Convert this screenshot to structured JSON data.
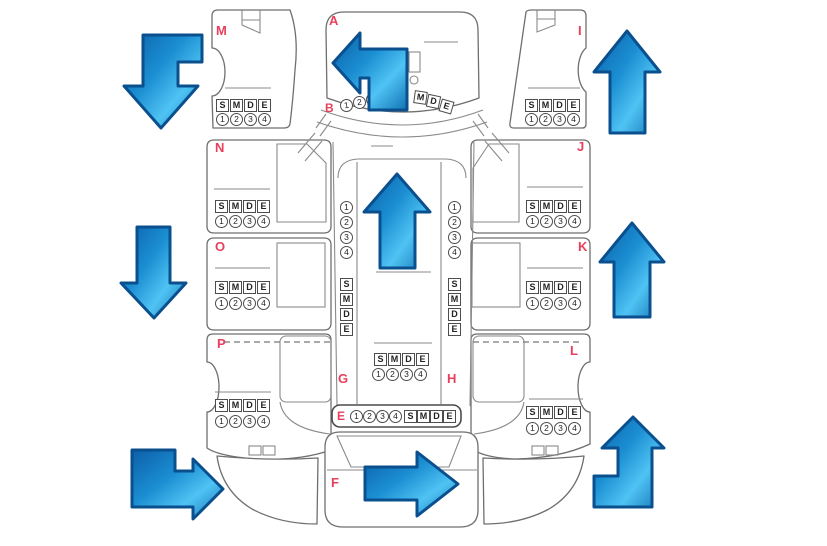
{
  "diagram": {
    "panels": {
      "A": "A",
      "B": "B",
      "E": "E",
      "F": "F",
      "G": "G",
      "H": "H",
      "I": "I",
      "J": "J",
      "K": "K",
      "L": "L",
      "M": "M",
      "N": "N",
      "O": "O",
      "P": "P"
    },
    "damage_codes": [
      "S",
      "M",
      "D",
      "E"
    ],
    "severity_levels": [
      "1",
      "2",
      "3",
      "4"
    ],
    "colors": {
      "panel_label": "#e8405c",
      "outline": "#6f6f6f",
      "arrow_dark": "#0c5fa8",
      "arrow_light": "#4fc3f3"
    },
    "arrows": [
      {
        "name": "arrow-front-left",
        "direction": "left-then-down"
      },
      {
        "name": "arrow-hood",
        "direction": "up-then-left"
      },
      {
        "name": "arrow-front-right",
        "direction": "up"
      },
      {
        "name": "arrow-mid-left",
        "direction": "down"
      },
      {
        "name": "arrow-roof",
        "direction": "up"
      },
      {
        "name": "arrow-mid-right",
        "direction": "up"
      },
      {
        "name": "arrow-rear-left",
        "direction": "down-then-right"
      },
      {
        "name": "arrow-tailgate",
        "direction": "right"
      },
      {
        "name": "arrow-rear-right",
        "direction": "right-then-up"
      }
    ]
  }
}
